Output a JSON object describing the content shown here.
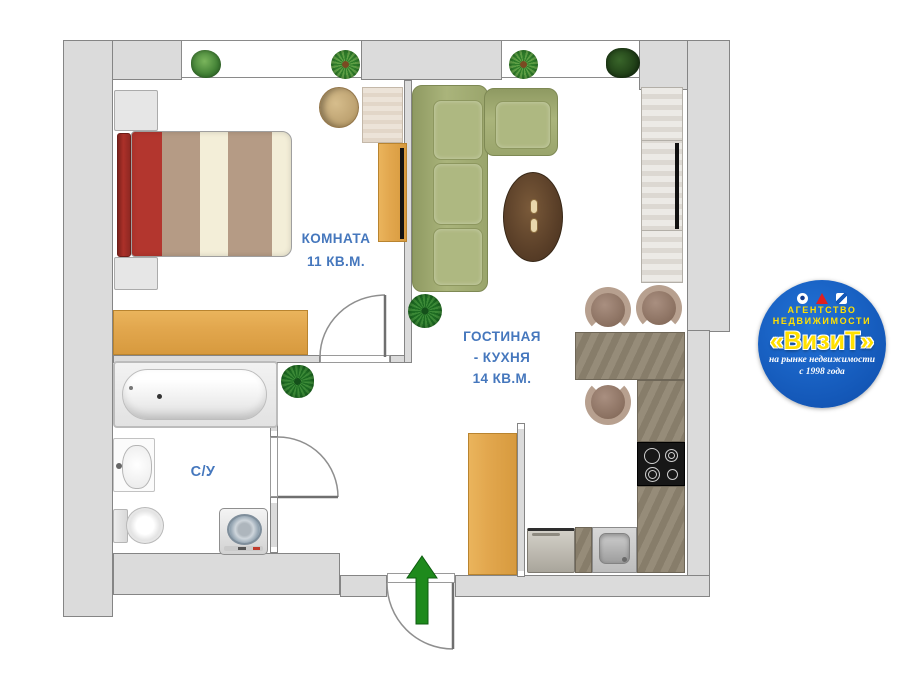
{
  "plan": {
    "title_type": "apartment-floor-plan",
    "labels": {
      "bedroom_name": "КОМНАТА",
      "bedroom_area": "11 КВ.М.",
      "living_name": "ГОСТИНАЯ",
      "living_name2": "- КУХНЯ",
      "living_area": "14 КВ.М.",
      "bathroom": "С/У"
    }
  },
  "logo": {
    "line1": "АГЕНТСТВО",
    "line2": "НЕДВИЖИМОСТИ",
    "brand": "«ВизиТ»",
    "tagline1": "на рынке недвижимости",
    "tagline2": "с 1998 года"
  },
  "colors": {
    "label_blue": "#4577bd",
    "wall_gray": "#dbdbdb",
    "logo_blue": "#1458b8",
    "logo_yellow": "#ffe000",
    "arrow_green": "#1e8a1c",
    "sofa_green": "#aab47b",
    "bed_red": "#ac3029",
    "wood_orange": "#e2a74e",
    "counter_taupe": "#8f8674"
  }
}
